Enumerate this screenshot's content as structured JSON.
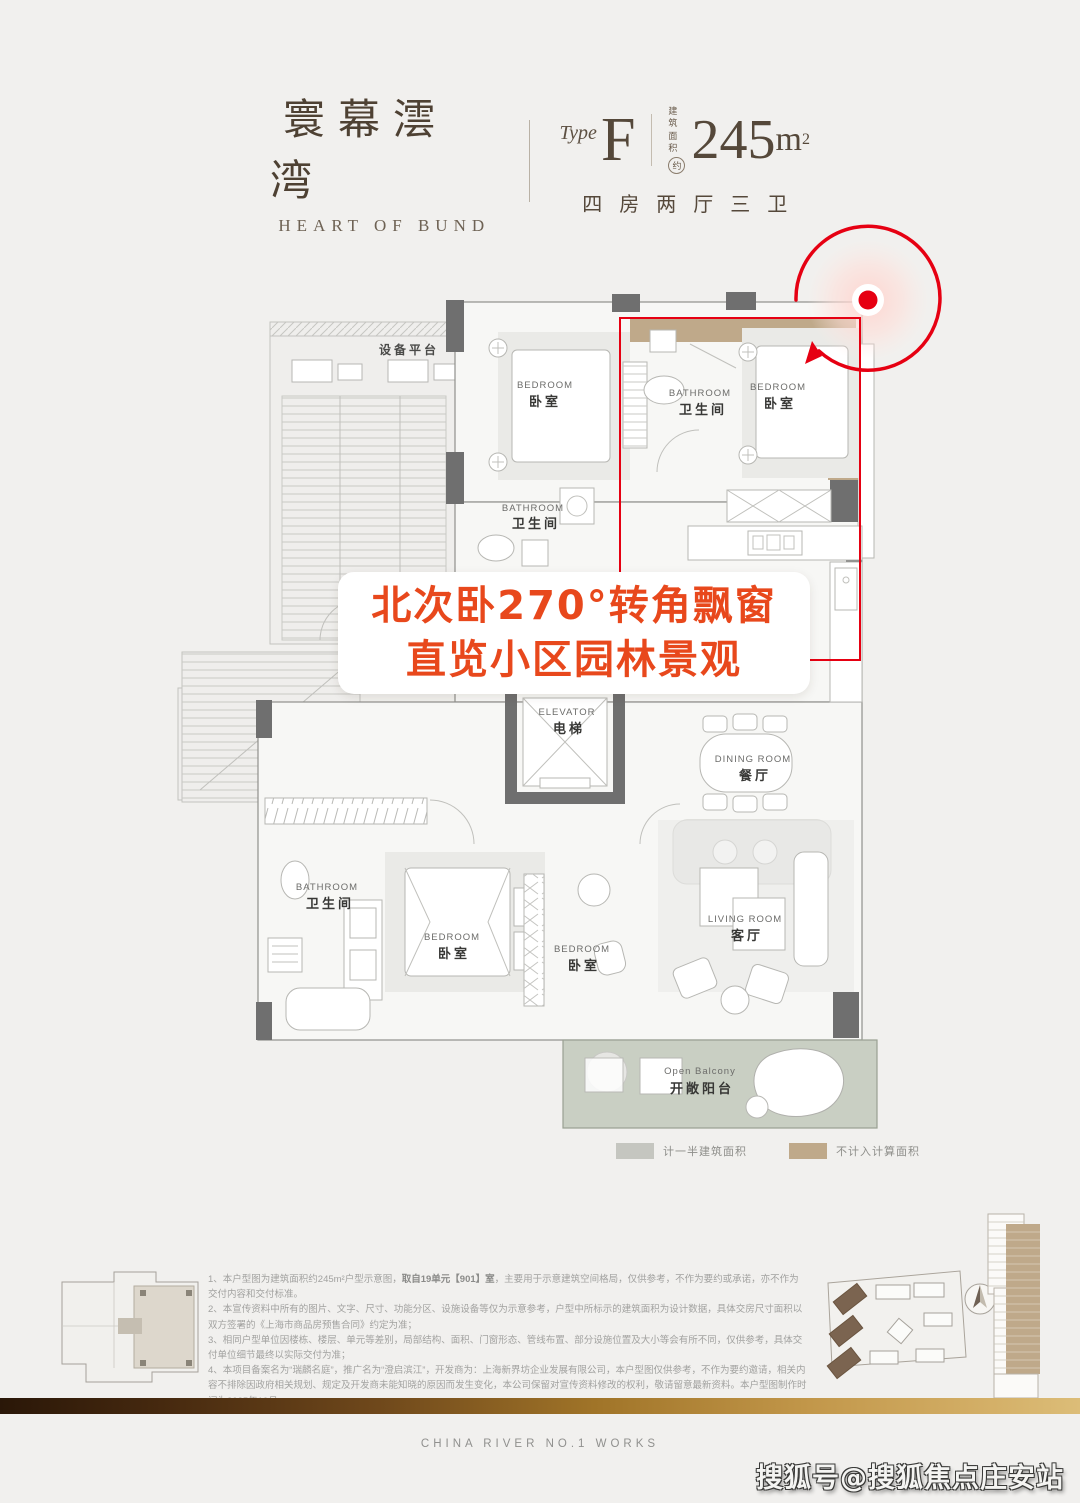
{
  "colors": {
    "accent_red": "#e60012",
    "callout_orange": "#e8481c",
    "bay_window_tan": "#bfa98a",
    "half_area_gray": "#c5c6c0",
    "balcony_green": "#c9cfc3",
    "brand_brown": "#55483a",
    "footer_gold": "#c2974a"
  },
  "header": {
    "brand_cn": "寰幕澐湾",
    "brand_en": "HEART OF BUND",
    "type_label": "Type",
    "type_value": "F",
    "area_label_l1": "建筑",
    "area_label_l2": "面积",
    "area_approx": "约",
    "area_value": "245",
    "area_unit": "m",
    "area_exp": "2",
    "layout_summary": "四房两厅三卫"
  },
  "callout": {
    "line1": "北次卧270°转角飘窗",
    "line2": "直览小区园林景观"
  },
  "plan": {
    "equipment_platform": "设备平台",
    "bedroom_en": "BEDROOM",
    "bedroom_cn": "卧室",
    "bathroom_en": "BATHROOM",
    "bathroom_cn": "卫生间",
    "elevator_en": "ELEVATOR",
    "elevator_cn": "电梯",
    "dining_en": "DINING ROOM",
    "dining_cn": "餐厅",
    "living_en": "LIVING ROOM",
    "living_cn": "客厅",
    "balcony_en": "Open Balcony",
    "balcony_cn": "开敞阳台"
  },
  "legend": {
    "half_label": "计一半建筑面积",
    "excluded_label": "不计入计算面积"
  },
  "disclaimer": {
    "l1a": "1、本户型图为建筑面积约245m²户型示意图，",
    "l1b": "取自19单元【901】室",
    "l1c": "，主要用于示意建筑空间格局，仅供参考，不作为要约或承诺，亦不作为交付内容和交付标准。",
    "l2": "2、本宣传资料中所有的图片、文字、尺寸、功能分区、设施设备等仅为示意参考，户型中所标示的建筑面积为设计数据，具体交房尺寸面积以双方签署的《上海市商品房预售合同》约定为准；",
    "l3": "3、相同户型单位因楼栋、楼层、单元等差别，局部结构、面积、门窗形态、管线布置、部分设施位置及大小等会有所不同，仅供参考，具体交付单位细节最终以实际交付为准；",
    "l4": "4、本项目备案名为“瑞麟名庭”，推广名为“澄启滨江”，开发商为：上海新界坊企业发展有限公司，本户型图仅供参考，不作为要约邀请，相关内容不排除因政府相关规划、规定及开发商未能知晓的原因而发生变化，本公司保留对宣传资料修改的权利，敬请留意最新资料。本户型图制作时间为2025年10月。"
  },
  "footer": {
    "works": "CHINA RIVER NO.1 WORKS",
    "watermark": "搜狐号@搜狐焦点庄安站"
  }
}
